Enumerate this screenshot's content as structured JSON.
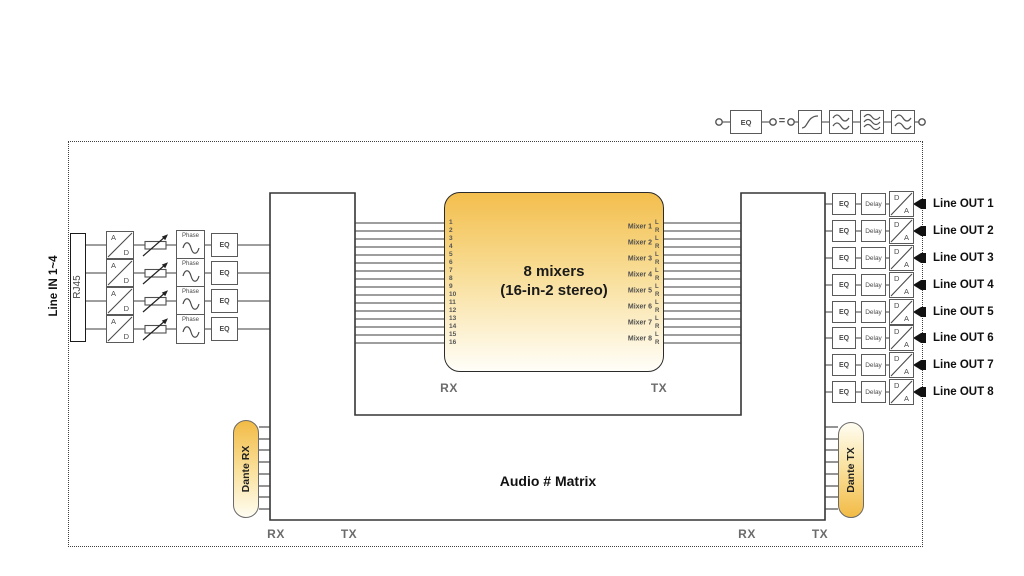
{
  "legend": {
    "eq_label": "EQ",
    "equals_sign": "="
  },
  "line_in": {
    "group_label": "Line IN 1~4",
    "connector_label": "RJ45",
    "ad_top": "A",
    "ad_bottom": "D",
    "phase_label": "Phase",
    "eq_label": "EQ"
  },
  "mixer": {
    "title_line1": "8 mixers",
    "title_line2": "(16-in-2 stereo)",
    "rx_label": "RX",
    "tx_label": "TX",
    "input_channels": [
      "1",
      "2",
      "3",
      "4",
      "5",
      "6",
      "7",
      "8",
      "9",
      "10",
      "11",
      "12",
      "13",
      "14",
      "15",
      "16"
    ],
    "outputs": [
      {
        "label": "Mixer 1",
        "left": "L",
        "right": "R"
      },
      {
        "label": "Mixer 2",
        "left": "L",
        "right": "R"
      },
      {
        "label": "Mixer 3",
        "left": "L",
        "right": "R"
      },
      {
        "label": "Mixer 4",
        "left": "L",
        "right": "R"
      },
      {
        "label": "Mixer 5",
        "left": "L",
        "right": "R"
      },
      {
        "label": "Mixer 6",
        "left": "L",
        "right": "R"
      },
      {
        "label": "Mixer 7",
        "left": "L",
        "right": "R"
      },
      {
        "label": "Mixer 8",
        "left": "L",
        "right": "R"
      }
    ]
  },
  "matrix": {
    "title": "Audio # Matrix",
    "bottom_left_rx": "RX",
    "bottom_left_tx": "TX",
    "bottom_right_rx": "RX",
    "bottom_right_tx": "TX"
  },
  "dante": {
    "rx_label": "Dante RX",
    "tx_label": "Dante TX"
  },
  "line_out": {
    "eq_label": "EQ",
    "delay_label": "Delay",
    "da_top": "D",
    "da_bottom": "A",
    "rows": [
      "Line OUT 1",
      "Line OUT 2",
      "Line OUT 3",
      "Line OUT 4",
      "Line OUT 5",
      "Line OUT 6",
      "Line OUT 7",
      "Line OUT 8"
    ]
  },
  "colors": {
    "accent_yellow_top": "#F3BE4D",
    "accent_yellow_bottom": "#FFFDF2",
    "wire": "#3c3c3c",
    "box_border": "#5a5a5a"
  }
}
